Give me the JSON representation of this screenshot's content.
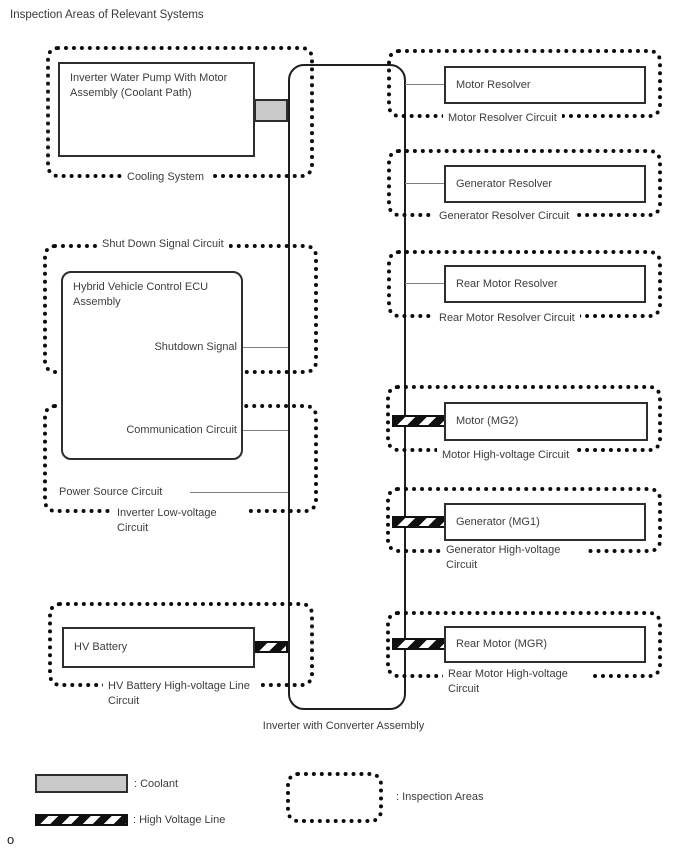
{
  "title": "Inspection Areas of Relevant Systems",
  "cooling_system": {
    "component": "Inverter Water Pump With Motor Assembly (Coolant Path)",
    "area_label": "Cooling System"
  },
  "shutdown_area": {
    "area_label": "Shut Down Signal Circuit",
    "component": "Hybrid Vehicle Control ECU Assembly",
    "shutdown_signal": "Shutdown Signal"
  },
  "low_voltage_area": {
    "communication": "Communication Circuit",
    "power_source": "Power Source Circuit",
    "area_label": "Inverter Low-voltage Circuit"
  },
  "battery_area": {
    "component": "HV Battery",
    "area_label": "HV Battery High-voltage Line Circuit"
  },
  "inverter": {
    "label": "Inverter with Converter Assembly"
  },
  "right_areas": [
    {
      "component": "Motor Resolver",
      "area_label": "Motor Resolver Circuit",
      "connector": "signal"
    },
    {
      "component": "Generator Resolver",
      "area_label": "Generator Resolver Circuit",
      "connector": "signal"
    },
    {
      "component": "Rear Motor Resolver",
      "area_label": "Rear Motor Resolver Circuit",
      "connector": "signal"
    },
    {
      "component": "Motor (MG2)",
      "area_label": "Motor High-voltage Circuit",
      "connector": "high-voltage"
    },
    {
      "component": "Generator (MG1)",
      "area_label": "Generator High-voltage Circuit",
      "connector": "high-voltage"
    },
    {
      "component": "Rear Motor (MGR)",
      "area_label": "Rear Motor High-voltage Circuit",
      "connector": "high-voltage"
    }
  ],
  "legend": {
    "coolant": ": Coolant",
    "high_voltage_line": ": High Voltage Line",
    "inspection_areas": ": Inspection Areas"
  },
  "footnote": "o",
  "colors": {
    "coolant_fill": "#c9c9c9",
    "line_color": "#1f1f1f",
    "connector_gray": "#808080"
  }
}
